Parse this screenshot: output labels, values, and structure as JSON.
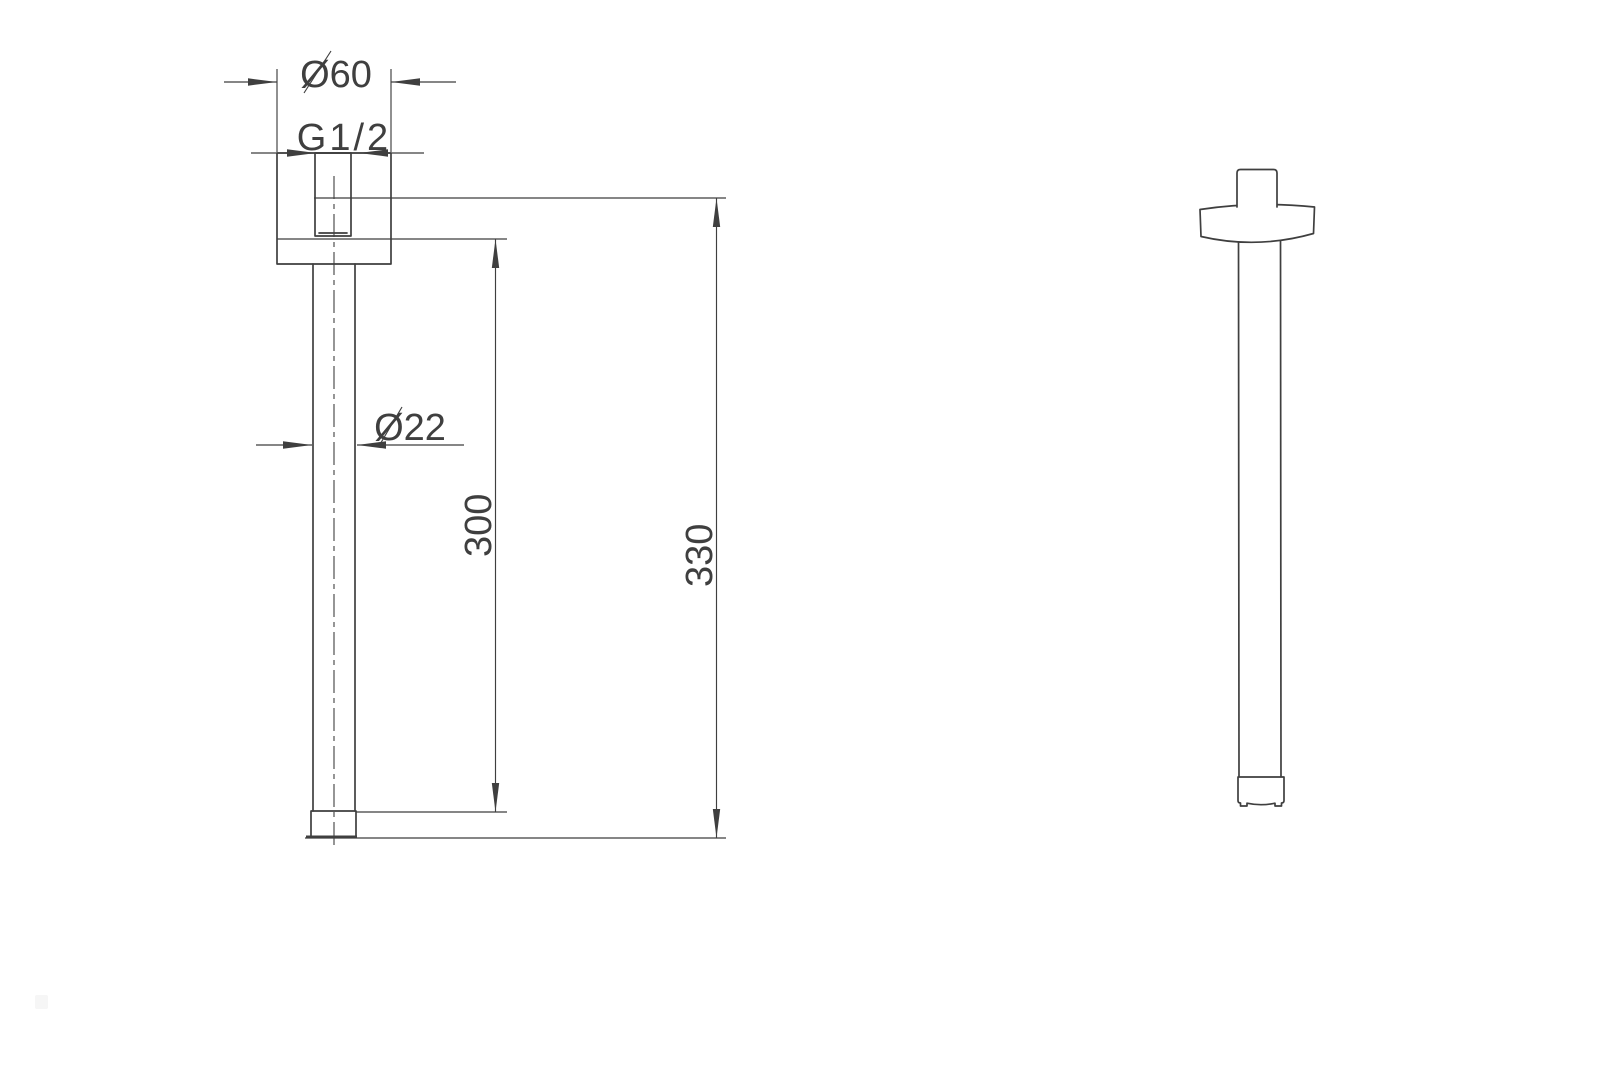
{
  "drawing": {
    "line_color": "#3f3f3f",
    "background_color": "#ffffff"
  },
  "front_view": {
    "labels": {
      "flange_diameter": "Ø60",
      "thread_size": "G1/2",
      "tube_diameter": "Ø22",
      "arm_length": "300",
      "overall_length": "330"
    },
    "values": {
      "flange_diameter_mm": 60,
      "thread_spec": "G1/2",
      "tube_diameter_mm": 22,
      "arm_length_mm": 300,
      "overall_length_mm": 330
    }
  }
}
